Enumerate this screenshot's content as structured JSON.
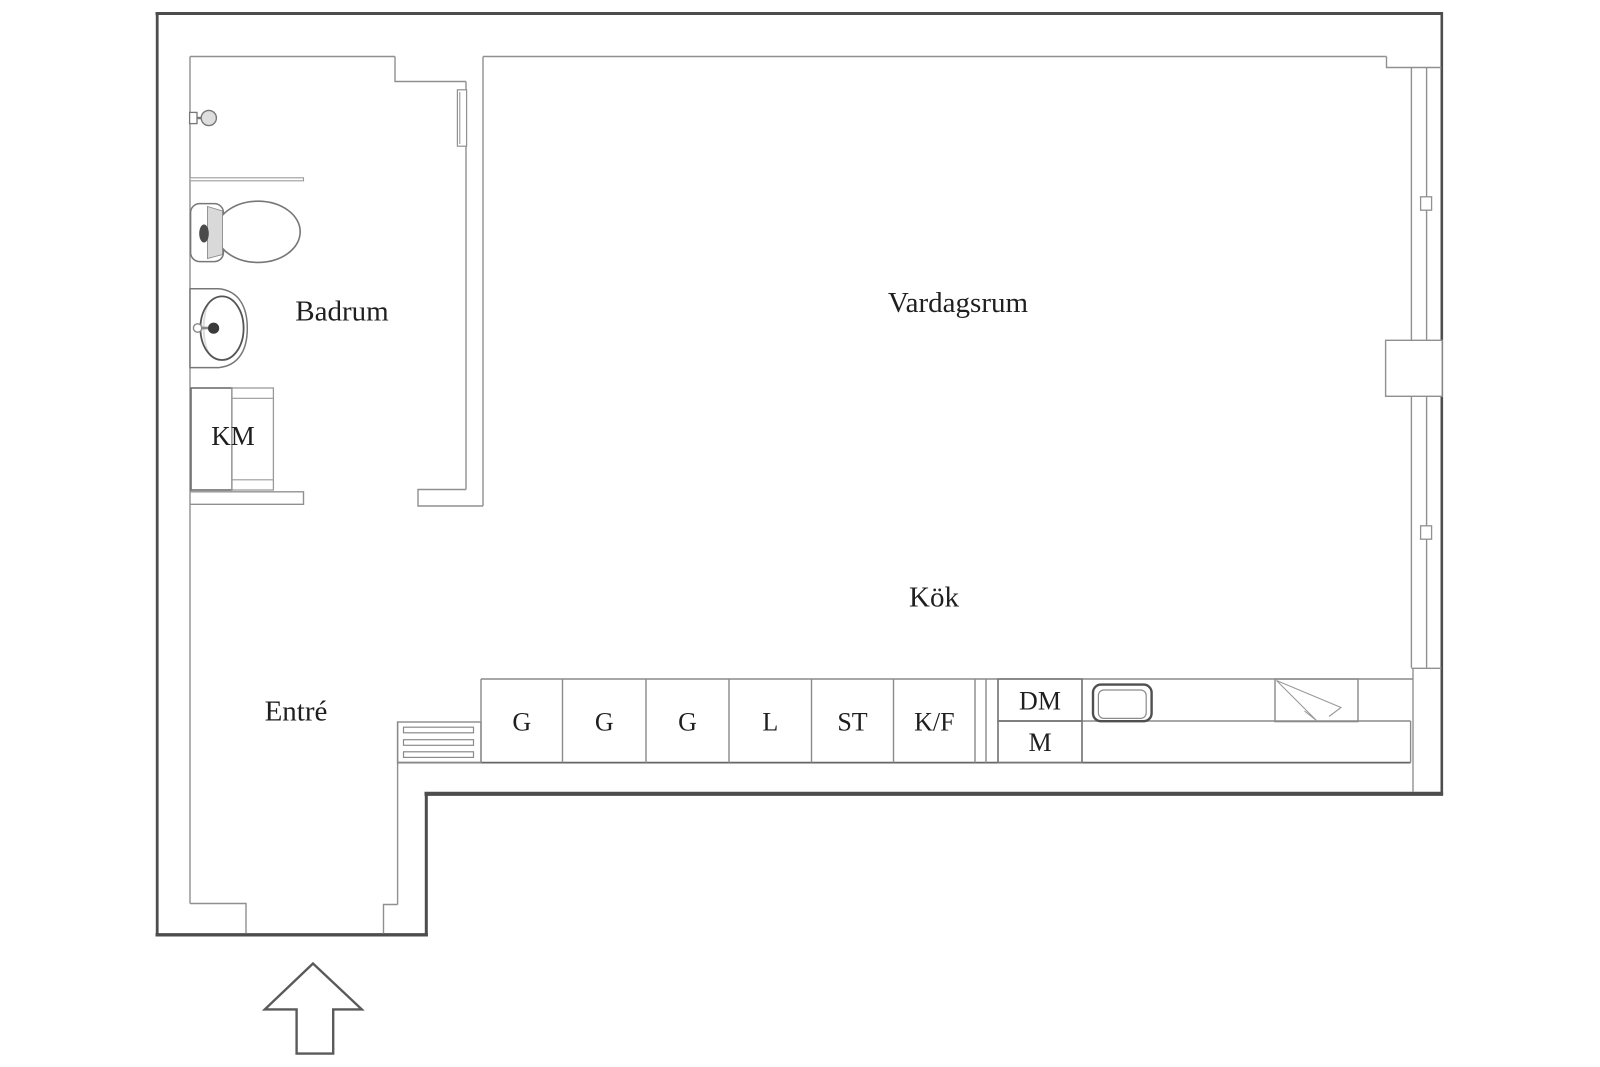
{
  "document": {
    "type": "floor-plan",
    "language": "sv"
  },
  "colors": {
    "background": "#ffffff",
    "outer_wall": "#4d4d4d",
    "inner_line": "#909090",
    "fixture_line": "#777777",
    "text": "#1f1f1f"
  },
  "rooms": {
    "badrum": {
      "label": "Badrum"
    },
    "vardagsrum": {
      "label": "Vardagsrum"
    },
    "kok": {
      "label": "Kök"
    },
    "entre": {
      "label": "Entré"
    }
  },
  "appliances": {
    "washing_machine": {
      "label": "KM"
    },
    "dishwasher": {
      "label": "DM"
    },
    "micro": {
      "label": "M"
    }
  },
  "kitchen_cabinets": [
    {
      "label": "G"
    },
    {
      "label": "G"
    },
    {
      "label": "G"
    },
    {
      "label": "L"
    },
    {
      "label": "ST"
    },
    {
      "label": "K/F"
    }
  ]
}
